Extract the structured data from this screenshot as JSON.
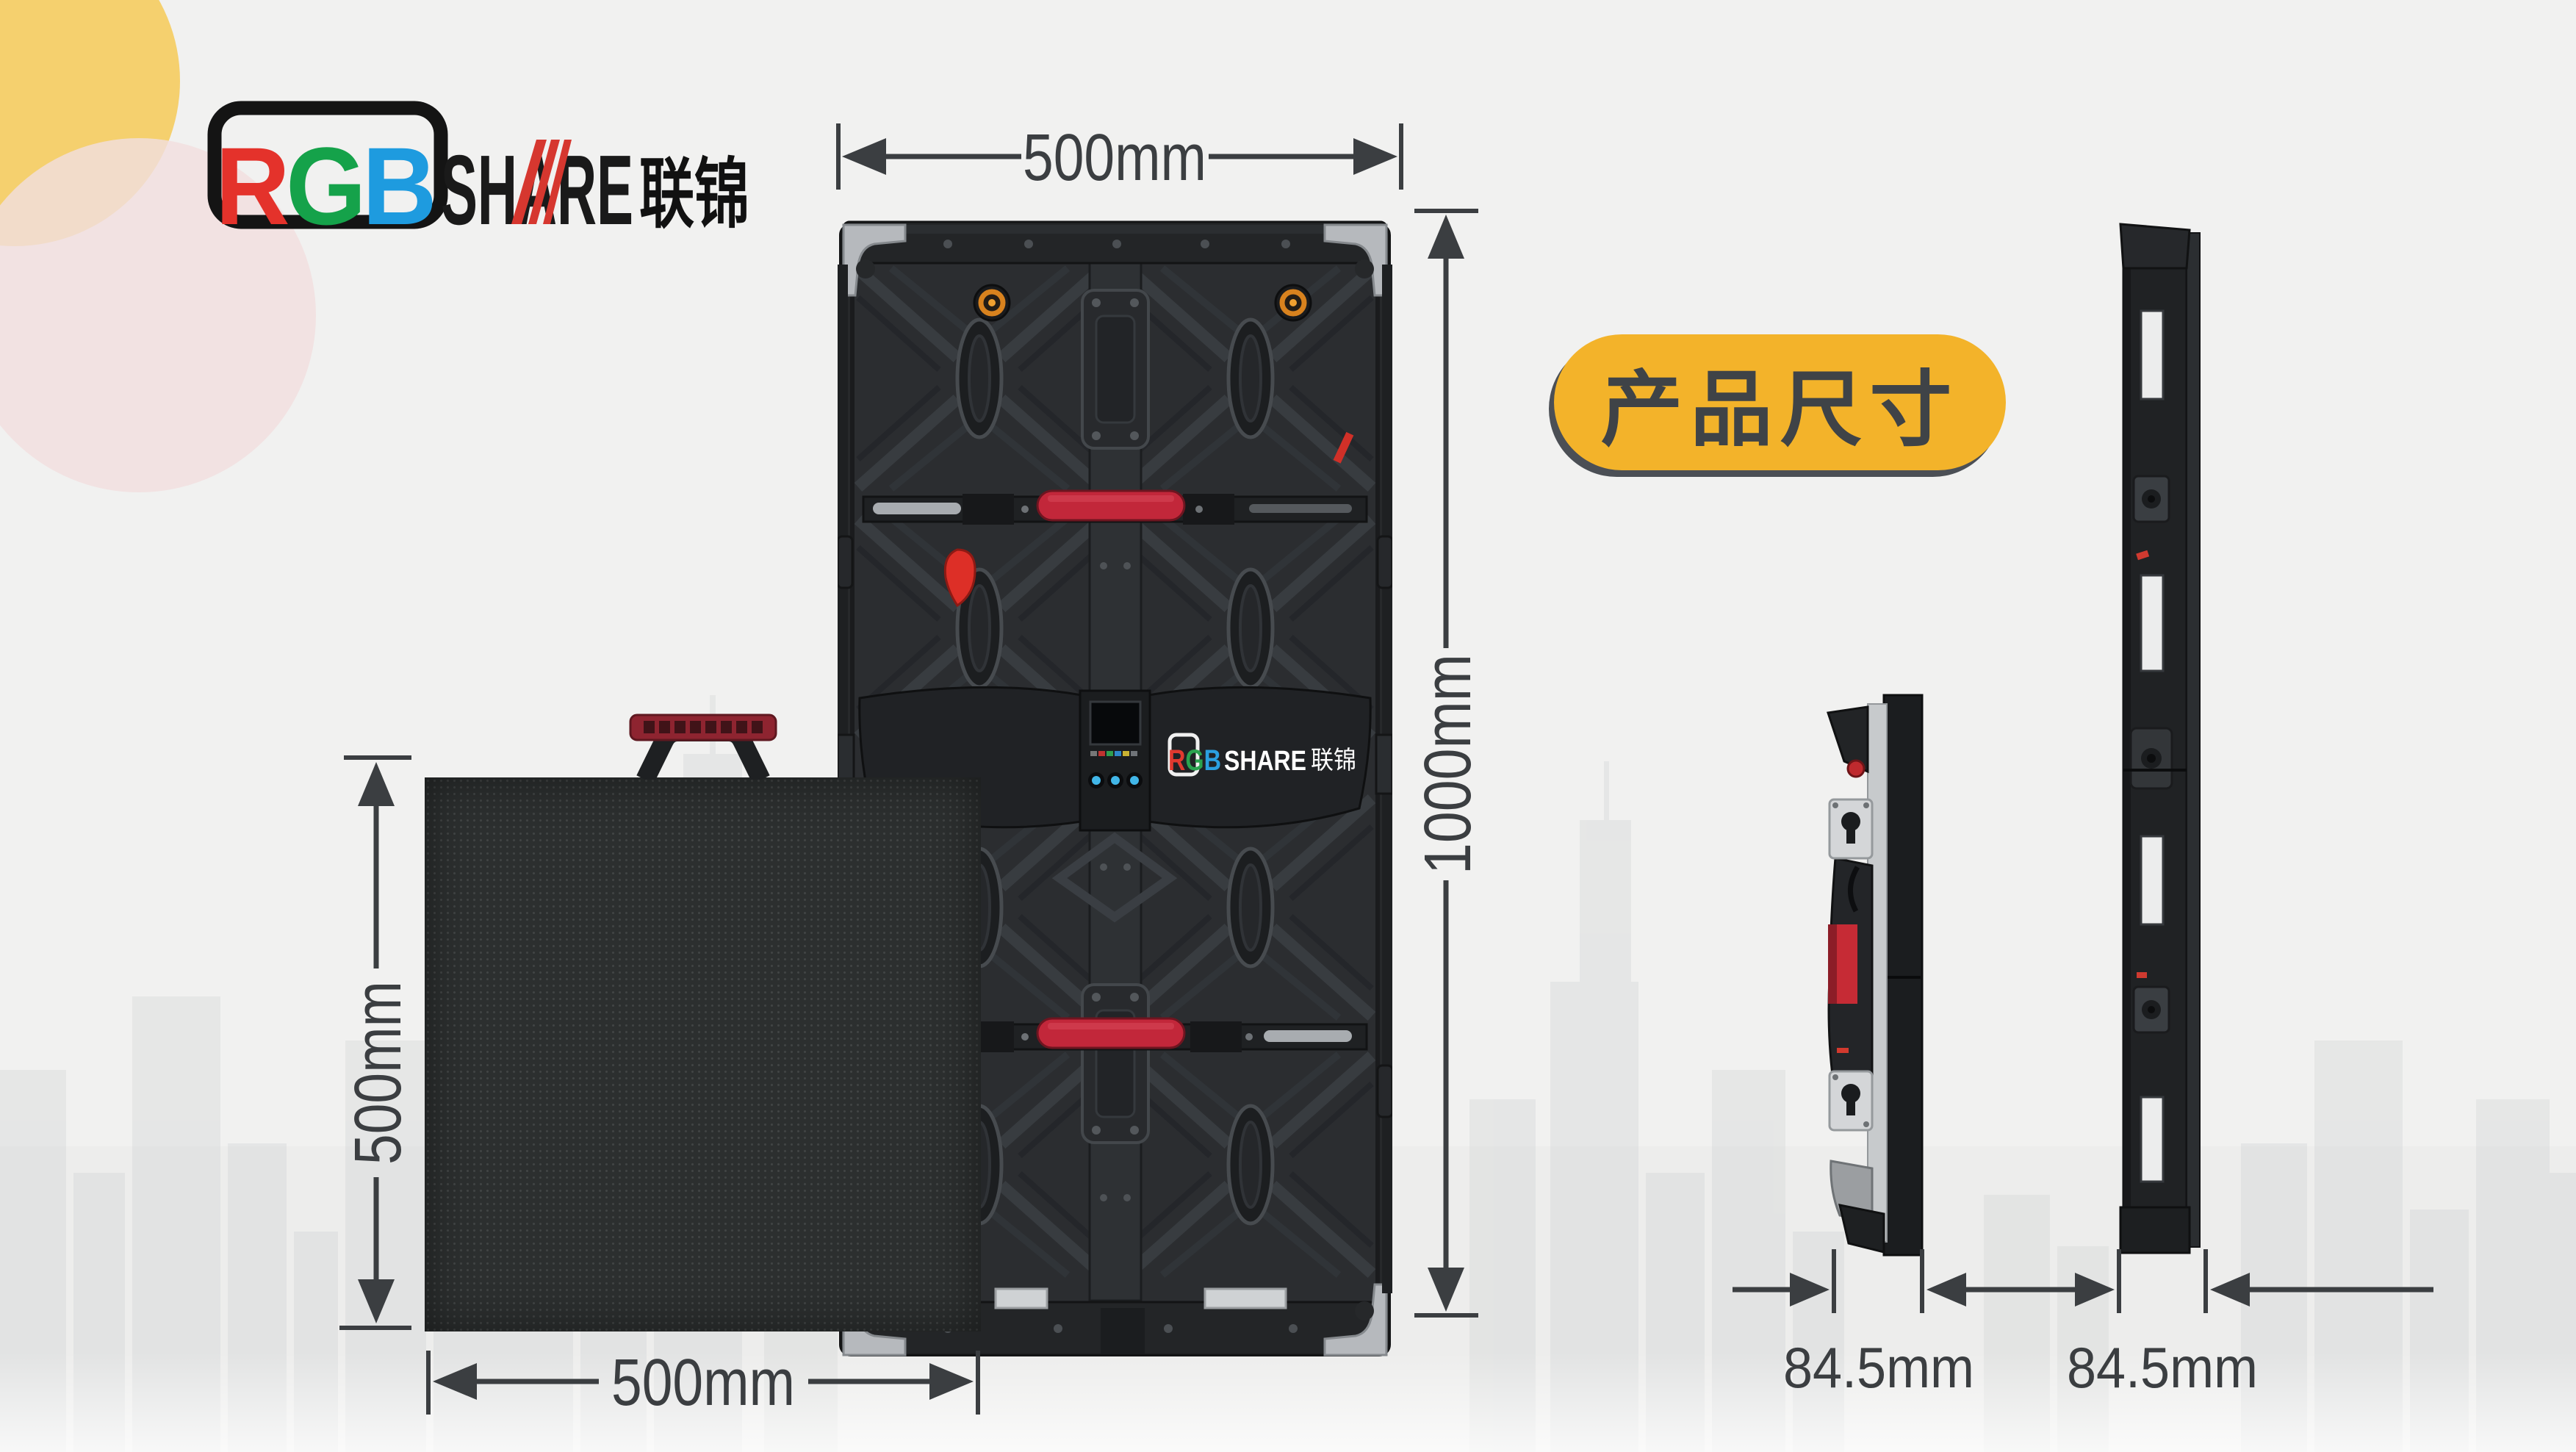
{
  "brand": {
    "r": "R",
    "g": "G",
    "b": "B",
    "share": "SHARE",
    "cn": "联锦"
  },
  "badge": {
    "label": "产品尺寸"
  },
  "dimensions": {
    "back_width": "500mm",
    "back_height": "1000mm",
    "front_height": "500mm",
    "front_width": "500mm",
    "side_depth_left": "84.5mm",
    "side_depth_right": "84.5mm"
  },
  "cabinet_logo": {
    "r": "R",
    "g": "G",
    "b": "B",
    "share": "SHARE",
    "cn": "联锦"
  },
  "colors": {
    "accent_yellow": "#F3B32A",
    "logo_red": "#E4322B",
    "logo_green": "#15A24A",
    "logo_blue": "#1E9BDF",
    "grip_red": "#C2273A",
    "dimension_gray": "#3B3E41"
  }
}
